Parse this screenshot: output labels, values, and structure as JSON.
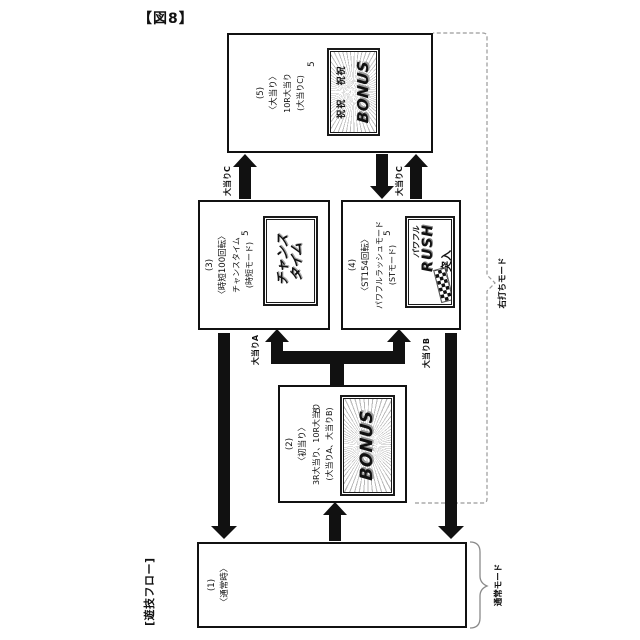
{
  "figure_label": "【図8】",
  "flow_label": "[遊技フロー]",
  "ref_number": "5",
  "boxes": {
    "normal": {
      "number": "(1)",
      "title": "〈通常時〉"
    },
    "first_hit": {
      "number": "(2)",
      "title": "〈初当り〉",
      "detail1": "3R大当り、10R大当り",
      "detail2": "(大当りA、大当りB)",
      "screen_main": "BONUS"
    },
    "chance_time": {
      "number": "(3)",
      "title": "〈時短100回転〉",
      "detail1": "チャンスタイム",
      "detail2": "(時短モード)",
      "screen_line1": "チャンス",
      "screen_line2": "タイム"
    },
    "powerful_rush": {
      "number": "(4)",
      "title": "〈ST154回転〉",
      "detail1": "パワフルラッシュモード",
      "detail2": "(STモード)",
      "screen_line1": "パワフル",
      "screen_line2": "RUSH",
      "screen_line3": "突入"
    },
    "jackpot": {
      "number": "(5)",
      "title": "〈大当り〉",
      "detail1": "10R大当り",
      "detail2": "(大当りC)",
      "screen_main": "BONUS",
      "screen_deco1": "祝祝",
      "screen_deco2": "祝祝"
    }
  },
  "arrow_labels": {
    "jackpot_a": "大当りA",
    "jackpot_b": "大当りB",
    "jackpot_c_from_chance": "大当りC",
    "jackpot_c_from_rush": "大当りC"
  },
  "mode_labels": {
    "right_strike": "右打ちモード",
    "normal": "通常モード"
  }
}
